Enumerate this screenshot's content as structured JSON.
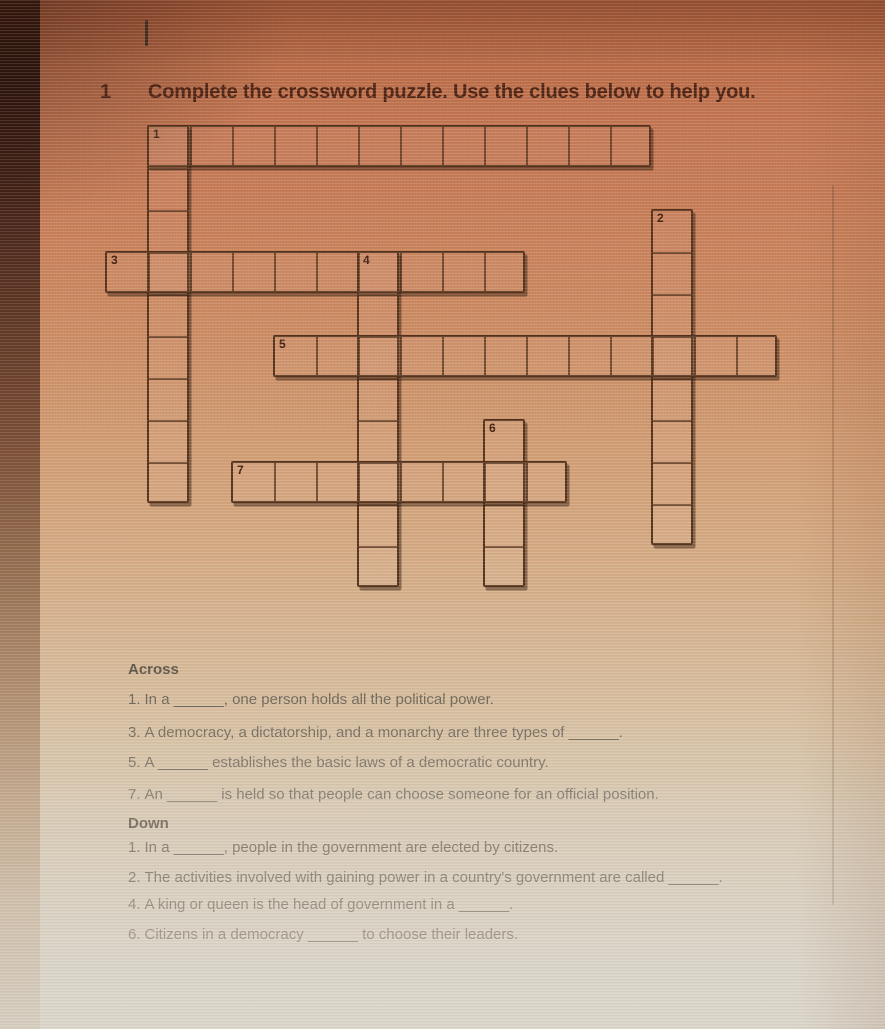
{
  "colors": {
    "page_top": "#b96743",
    "page_bottom": "#dbd6cb",
    "title_ink": "#4d2212",
    "grid_ink": "#523019",
    "clue_ink": "#847a6c"
  },
  "header": {
    "section_number": "1",
    "title": "Complete the crossword puzzle. Use the clues below to help you."
  },
  "puzzle": {
    "grid": {
      "cols": 17,
      "rows": 12,
      "cell_px": 42
    },
    "entries": [
      {
        "number": "1",
        "direction": "across",
        "row": 0,
        "col": 1,
        "length": 12
      },
      {
        "number": "1",
        "direction": "down",
        "row": 0,
        "col": 1,
        "length": 9
      },
      {
        "number": "2",
        "direction": "down",
        "row": 2,
        "col": 13,
        "length": 8
      },
      {
        "number": "3",
        "direction": "across",
        "row": 3,
        "col": 0,
        "length": 10
      },
      {
        "number": "4",
        "direction": "down",
        "row": 3,
        "col": 6,
        "length": 8
      },
      {
        "number": "5",
        "direction": "across",
        "row": 5,
        "col": 4,
        "length": 12
      },
      {
        "number": "6",
        "direction": "down",
        "row": 7,
        "col": 9,
        "length": 4
      },
      {
        "number": "7",
        "direction": "across",
        "row": 8,
        "col": 3,
        "length": 8
      }
    ]
  },
  "clues": {
    "across_heading": "Across",
    "across": [
      {
        "number": "1.",
        "text": "In a ______, one person holds all the political power."
      },
      {
        "number": "3.",
        "text": "A democracy, a dictatorship, and a monarchy are three types of ______."
      },
      {
        "number": "5.",
        "text": "A ______ establishes the basic laws of a democratic country."
      },
      {
        "number": "7.",
        "text": "An ______ is held so that people can choose someone for an official position."
      }
    ],
    "down_heading": "Down",
    "down": [
      {
        "number": "1.",
        "text": "In a ______, people in the government are elected by citizens."
      },
      {
        "number": "2.",
        "text": "The activities involved with gaining power in a country's government are called ______."
      },
      {
        "number": "4.",
        "text": "A king or queen is the head of government in a ______."
      },
      {
        "number": "6.",
        "text": "Citizens in a democracy ______ to choose their leaders."
      }
    ]
  }
}
